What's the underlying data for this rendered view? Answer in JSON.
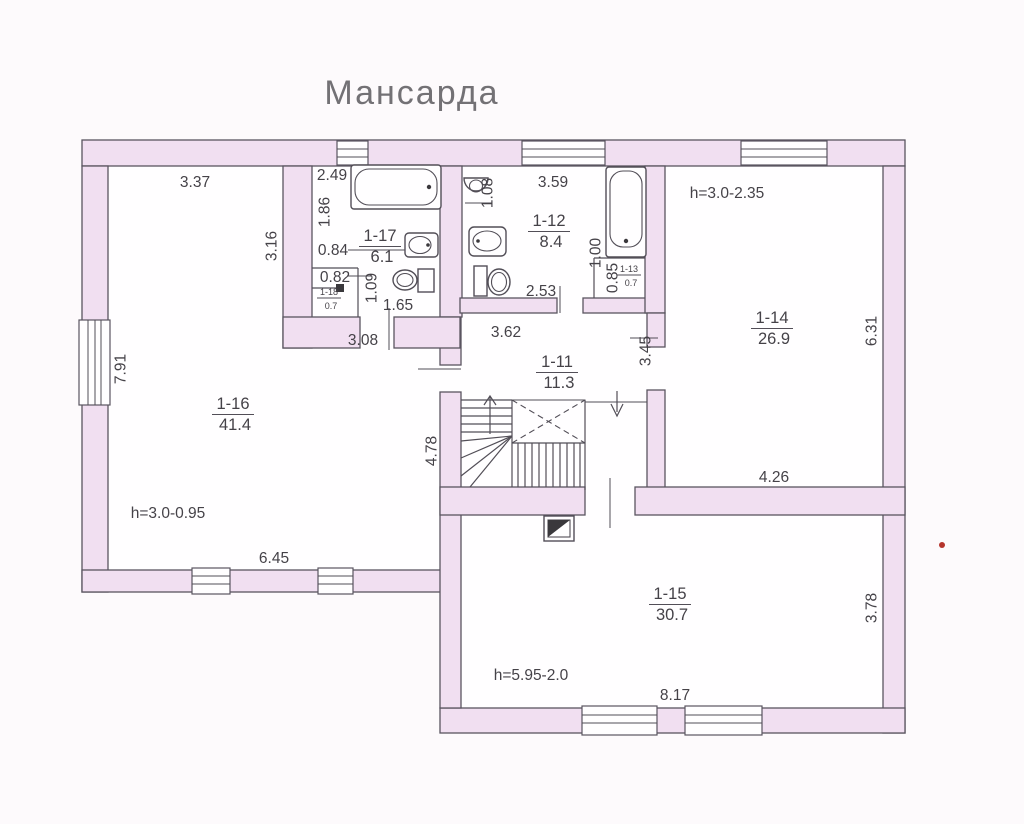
{
  "title": "Мансарда",
  "colors": {
    "wall_fill": "#f1dff1",
    "line": "#5a5560",
    "text": "#454248",
    "page": "#fdfafc",
    "interior": "#fffeff",
    "scan_mark_red": "#b5342c"
  },
  "rooms": [
    {
      "id": "1-16",
      "area": "41.4",
      "x": 233,
      "y": 409,
      "size": "normal"
    },
    {
      "id": "1-17",
      "area": "6.1",
      "x": 380,
      "y": 241,
      "size": "normal"
    },
    {
      "id": "1-12",
      "area": "8.4",
      "x": 549,
      "y": 226,
      "size": "normal"
    },
    {
      "id": "1-11",
      "area": "11.3",
      "x": 557,
      "y": 367,
      "size": "normal"
    },
    {
      "id": "1-14",
      "area": "26.9",
      "x": 772,
      "y": 323,
      "size": "normal"
    },
    {
      "id": "1-15",
      "area": "30.7",
      "x": 670,
      "y": 599,
      "size": "normal"
    },
    {
      "id": "1-13",
      "area": "0.7",
      "x": 629,
      "y": 272,
      "size": "tiny"
    },
    {
      "id": "1-18",
      "area": "0.7",
      "x": 329,
      "y": 295,
      "size": "tiny"
    }
  ],
  "dimensions": [
    {
      "t": "3.37",
      "x": 195,
      "y": 187
    },
    {
      "t": "2.49",
      "x": 332,
      "y": 180
    },
    {
      "t": "3.59",
      "x": 553,
      "y": 187
    },
    {
      "t": "h=3.0-2.35",
      "x": 727,
      "y": 198
    },
    {
      "t": "1.08",
      "x": 488,
      "y": 193,
      "v": 1
    },
    {
      "t": "1.86",
      "x": 325,
      "y": 212,
      "v": 1
    },
    {
      "t": "3.16",
      "x": 272,
      "y": 246,
      "v": 1
    },
    {
      "t": "0.84",
      "x": 333,
      "y": 255
    },
    {
      "t": "0.82",
      "x": 335,
      "y": 282
    },
    {
      "t": "1.09",
      "x": 372,
      "y": 288,
      "v": 1
    },
    {
      "t": "1.65",
      "x": 398,
      "y": 310
    },
    {
      "t": "1.00",
      "x": 596,
      "y": 253,
      "v": 1
    },
    {
      "t": "0.85",
      "x": 613,
      "y": 278,
      "v": 1
    },
    {
      "t": "2.53",
      "x": 541,
      "y": 296
    },
    {
      "t": "3.08",
      "x": 363,
      "y": 345
    },
    {
      "t": "3.62",
      "x": 506,
      "y": 337
    },
    {
      "t": "3.45",
      "x": 646,
      "y": 351,
      "v": 1
    },
    {
      "t": "7.91",
      "x": 121,
      "y": 369,
      "v": 1
    },
    {
      "t": "4.78",
      "x": 432,
      "y": 451,
      "v": 1
    },
    {
      "t": "6.31",
      "x": 872,
      "y": 331,
      "v": 1
    },
    {
      "t": "4.26",
      "x": 774,
      "y": 482
    },
    {
      "t": "6.45",
      "x": 274,
      "y": 563
    },
    {
      "t": "3.78",
      "x": 872,
      "y": 608,
      "v": 1
    },
    {
      "t": "h=3.0-0.95",
      "x": 168,
      "y": 518
    },
    {
      "t": "h=5.95-2.0",
      "x": 531,
      "y": 680
    },
    {
      "t": "8.17",
      "x": 675,
      "y": 700
    }
  ]
}
